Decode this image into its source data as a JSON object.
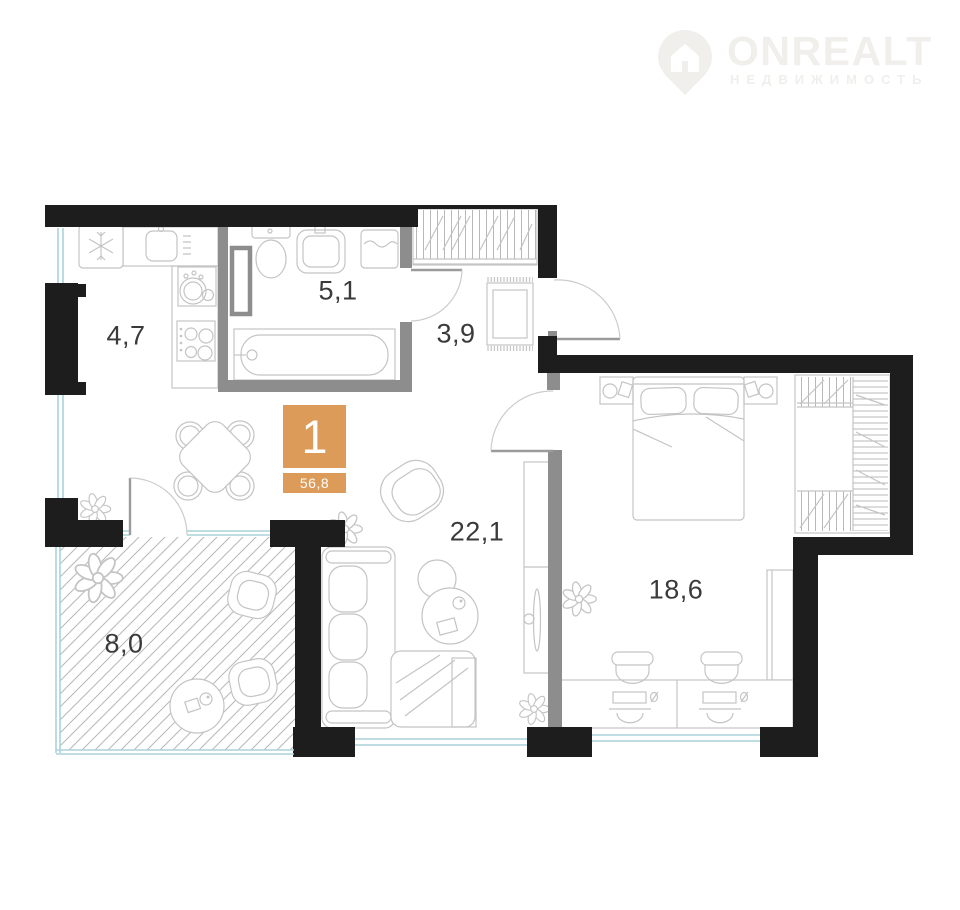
{
  "logo": {
    "brand": "ONREALT",
    "tagline": "НЕДВИЖИМОСТЬ"
  },
  "badge": {
    "rooms": "1",
    "area": "56,8"
  },
  "rooms": {
    "kitchen": {
      "area": "4,7"
    },
    "bathroom": {
      "area": "5,1"
    },
    "hallway": {
      "area": "3,9"
    },
    "living_room": {
      "area": "22,1"
    },
    "bedroom": {
      "area": "18,6"
    },
    "balcony": {
      "area": "8,0"
    }
  },
  "colors": {
    "wall": "#1d1d1d",
    "partition": "#8d8d8d",
    "window": "#a9d4da",
    "badge": "#DC9B59",
    "furniture": "#c4c4c4",
    "hatch": "#b8b8b8",
    "label": "#3a3a3a",
    "logo": "#f1efec"
  }
}
